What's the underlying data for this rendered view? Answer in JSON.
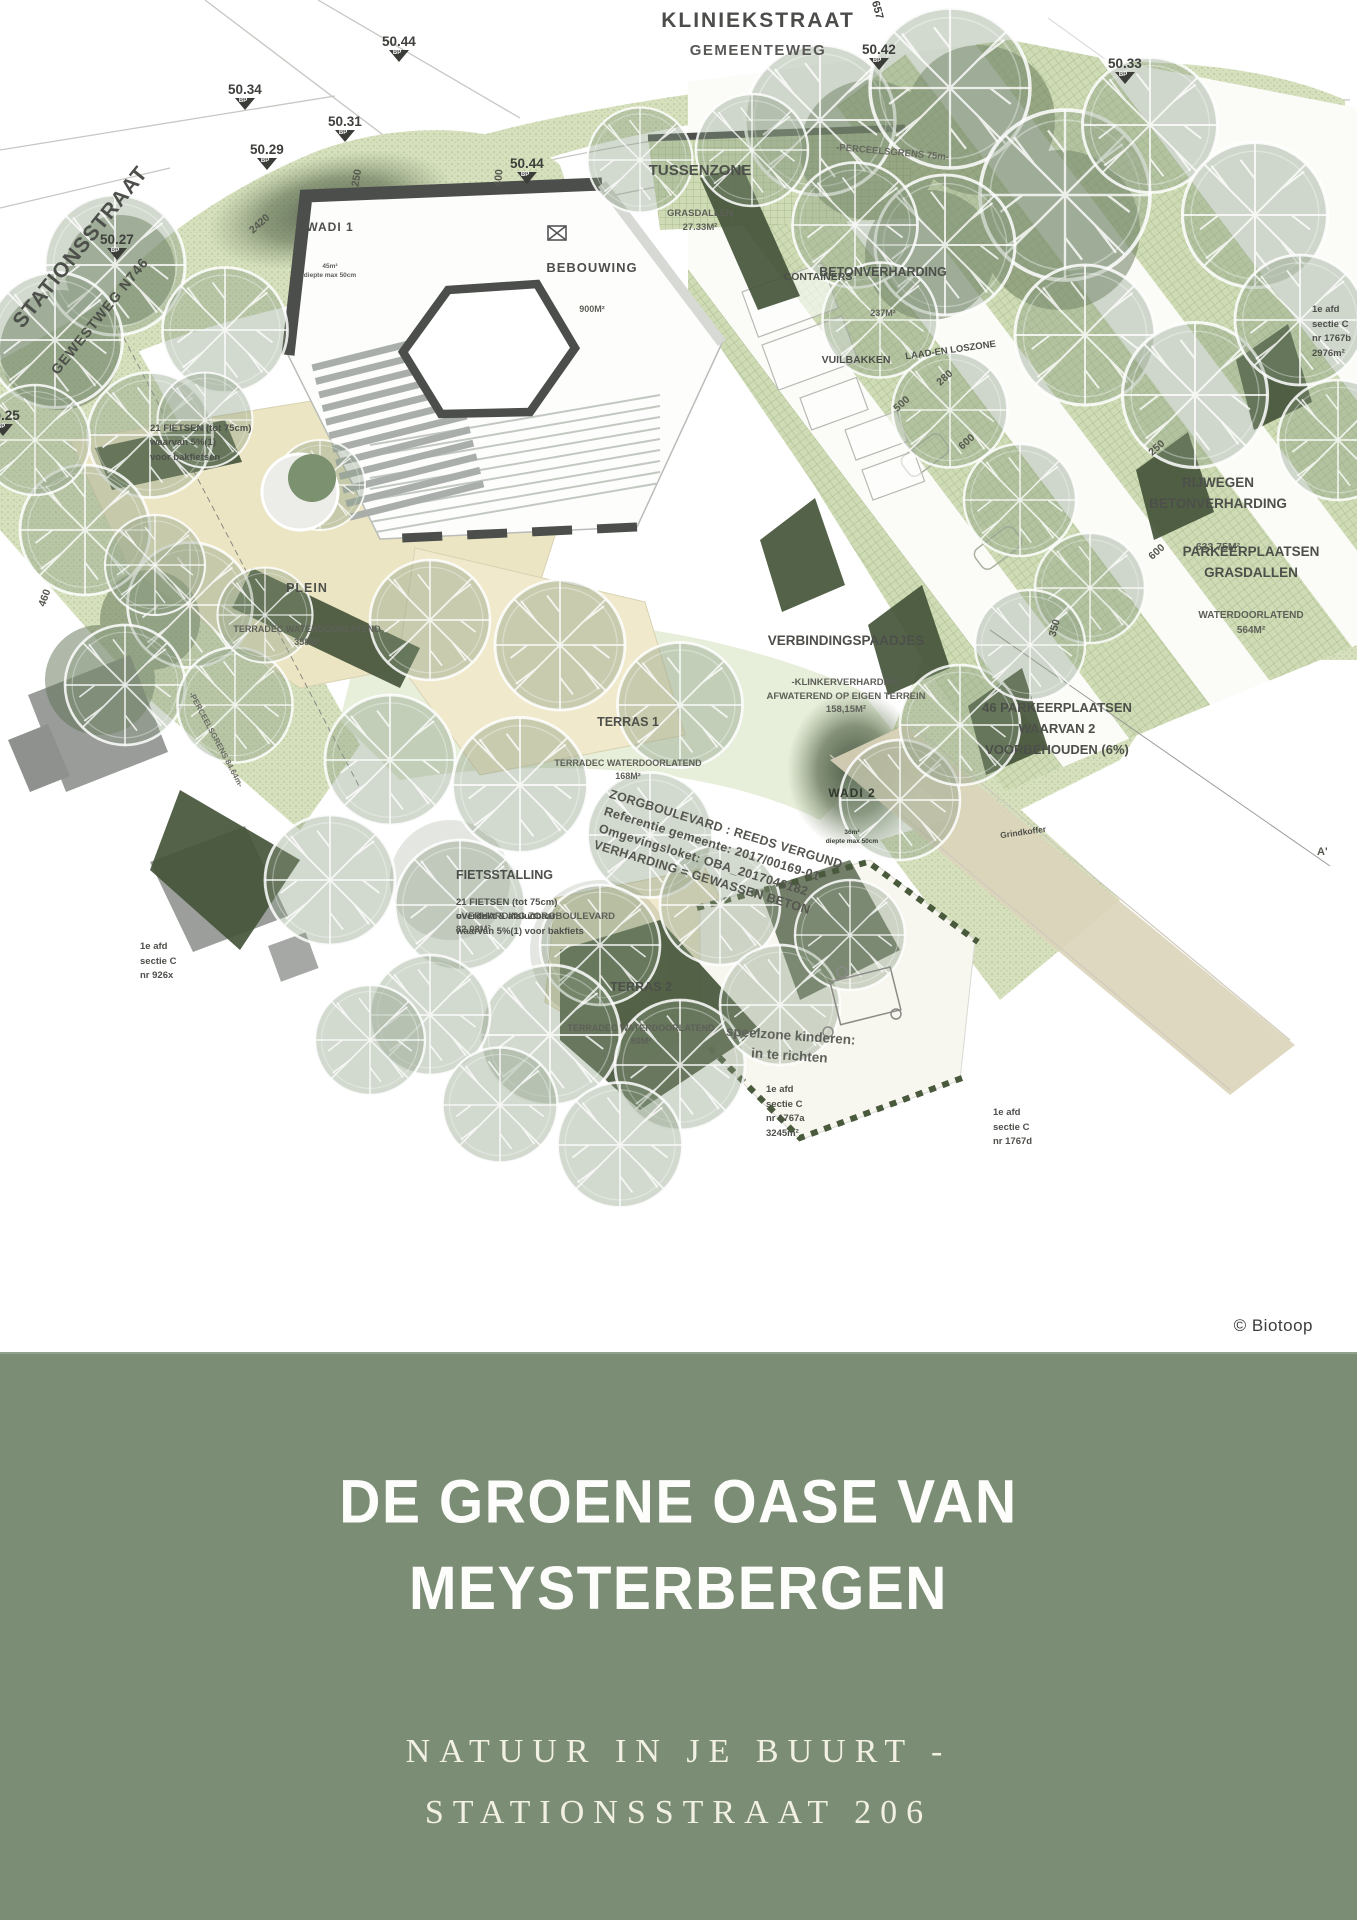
{
  "map": {
    "streets": {
      "kliniekstraat": "KLINIEKSTRAAT",
      "gemeenteweg": "GEMEENTEWEG",
      "stationsstraat": "STATIONSSTRAAT",
      "gewestweg": "GEWESTWEG N746"
    },
    "areas": {
      "tussenzone": {
        "title": "TUSSENZONE",
        "sub": "GRASDALLEN\n27.33M²"
      },
      "bebouwing": {
        "title": "BEBOUWING",
        "sub": "900M²"
      },
      "betonverharding": {
        "title": "BETONVERHARDING",
        "sub": "237M²"
      },
      "containers": {
        "title": "CONTAINERS"
      },
      "vuilbakken": {
        "title": "VUILBAKKEN"
      },
      "laad_en_loszone": {
        "title": "LAAD-EN LOSZONE"
      },
      "perceelsgrens_top": {
        "title": "-PERCEELSGRENS 75m-"
      },
      "perceelsgrens_left": {
        "title": "-PERCEELSGRENS 84.64m-"
      },
      "rijwegen": {
        "title": "RIJWEGEN\nBETONVERHARDING",
        "sub": "633.75M²"
      },
      "parkeerplaatsen": {
        "title": "PARKEERPLAATSEN\nGRASDALLEN",
        "sub": "WATERDOORLATEND\n564M²"
      },
      "verbindingspaadjes": {
        "title": "VERBINDINGSPAADJES",
        "sub": "-KLINKERVERHARDING\nAFWATEREND OP EIGEN TERREIN\n158,15M²"
      },
      "parkeerplaatsen_46": {
        "title": "46 PARKEERPLAATSEN\nWAARVAN 2\nVOORBEHOUDEN (6%)"
      },
      "wadi1": {
        "title": "WADI 1",
        "sub": "45m²\ndiepte max 50cm"
      },
      "wadi2": {
        "title": "WADI 2",
        "sub": "36m²\ndiepte max 50cm"
      },
      "plein": {
        "title": "PLEIN",
        "sub": "TERRADEC WATERDOORLATEND\n358M²"
      },
      "terras1": {
        "title": "TERRAS 1",
        "sub": "TERRADEC WATERDOORLATEND\n168M²"
      },
      "terras2": {
        "title": "TERRAS 2",
        "sub": "TERRADEC WATERDOORLATEND\n80M²"
      },
      "fietsstalling": {
        "title": "FIETSSTALLING",
        "sub": "=VERHARDING ZORGBOULEVARD\n82.08M²"
      },
      "fietsen_overdekt": {
        "title": "21 FIETSEN (tot 75cm)\noverdekt & afsluitbaar\nwaarvan 5%(1) voor bakfiets"
      },
      "fietsen_plein": {
        "title": "21 FIETSEN (tot 75cm)\nwaarvan 5%(1)\nvoor bakfietsen"
      },
      "speelzone": {
        "title": "speelzone kinderen:\nin te richten"
      },
      "zorgboulevard": {
        "title": "ZORGBOULEVARD : REEDS VERGUND\nReferentie gemeente:  2017/00169-01\nOmgevingsloket: OBA_2017046182\nVERHARDING = GEWASSEN BETON"
      },
      "grindkoffer": {
        "title": "Grindkoffer"
      }
    },
    "parcels": {
      "p926x": "1e afd\nsectie C\nnr 926x",
      "p1767a": "1e afd\nsectie C\nnr 1767a\n3245m²",
      "p1767b": "1e afd\nsectie C\nnr 1767b\n2976m²",
      "p1767d": "1e afd\nsectie C\nnr 1767d"
    },
    "spot_elevations": [
      "50.44",
      "50.42",
      "50.33",
      "50.34",
      "50.31",
      "50.29",
      "50.27",
      "50.25",
      "50.44",
      "657"
    ],
    "benchmark_label": "BP",
    "dimensions": [
      "2420",
      "250",
      "400",
      "280",
      "500",
      "600",
      "250",
      "600",
      "350",
      "460"
    ],
    "section_marker": "A'"
  },
  "credit": "© Biotoop",
  "banner": {
    "title": "DE GROENE OASE VAN\nMEYSTERBERGEN",
    "subtitle": "NATUUR IN JE BUURT -\nSTATIONSSTRAAT 206",
    "background": "#7b8d74",
    "title_color": "#fdfdfb",
    "subtitle_color": "#f2f0e3"
  }
}
